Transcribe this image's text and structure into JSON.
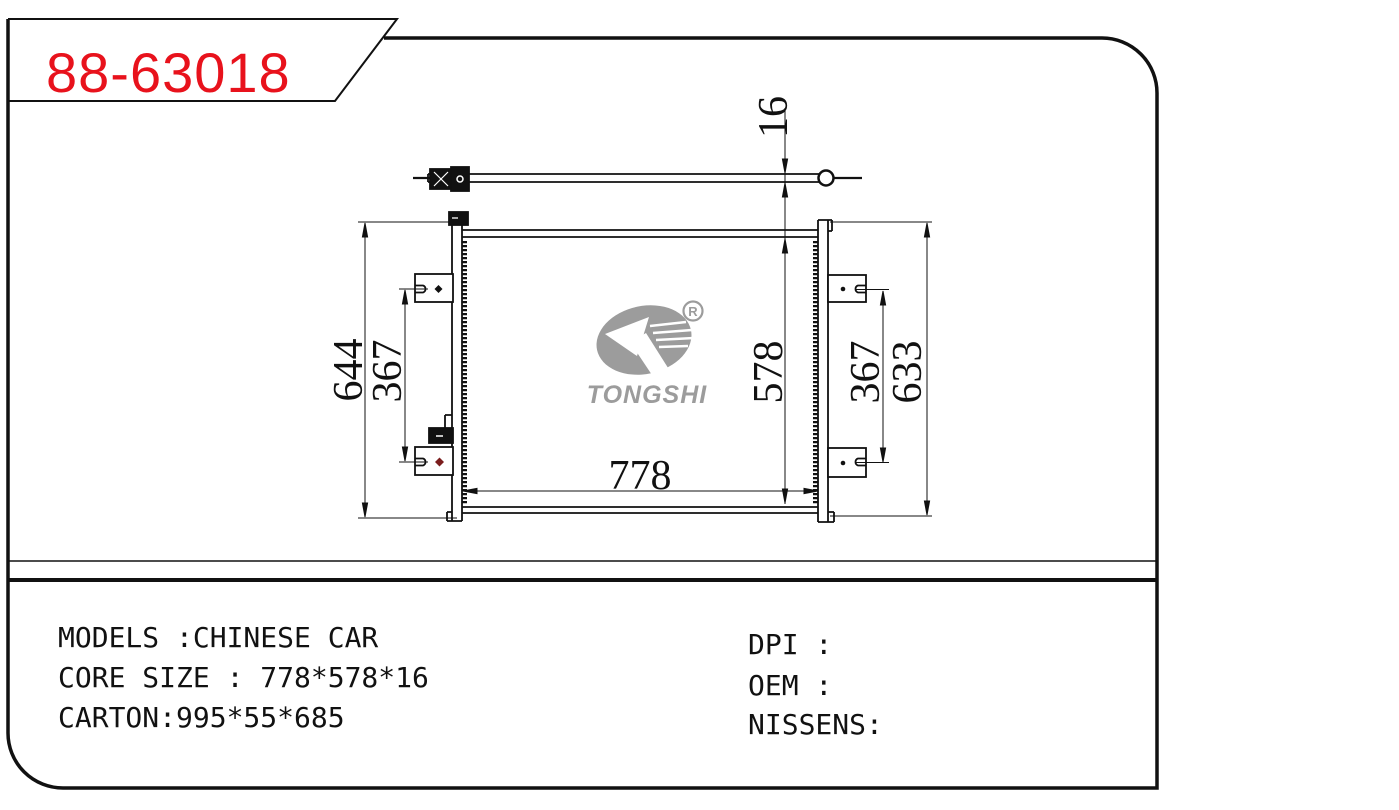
{
  "part_number": {
    "text": "88-63018",
    "color": "#e8121c"
  },
  "logo": {
    "brand": "TONGSHI",
    "registered_mark": "R",
    "color": "#9c9c9c"
  },
  "dimensions": {
    "overall_height_left": "644",
    "mount_span_left": "367",
    "core_width": "778",
    "core_height": "578",
    "mount_span_right": "367",
    "overall_height_right": "633",
    "core_thickness": "16"
  },
  "spec_panel": {
    "models_line": "MODELS :CHINESE CAR",
    "core_size_line": "CORE SIZE : 778*578*16",
    "carton_line": "CARTON:995*55*685",
    "dpi_line": "DPI :",
    "oem_line": "OEM :",
    "nissens_line": "NISSENS:"
  }
}
